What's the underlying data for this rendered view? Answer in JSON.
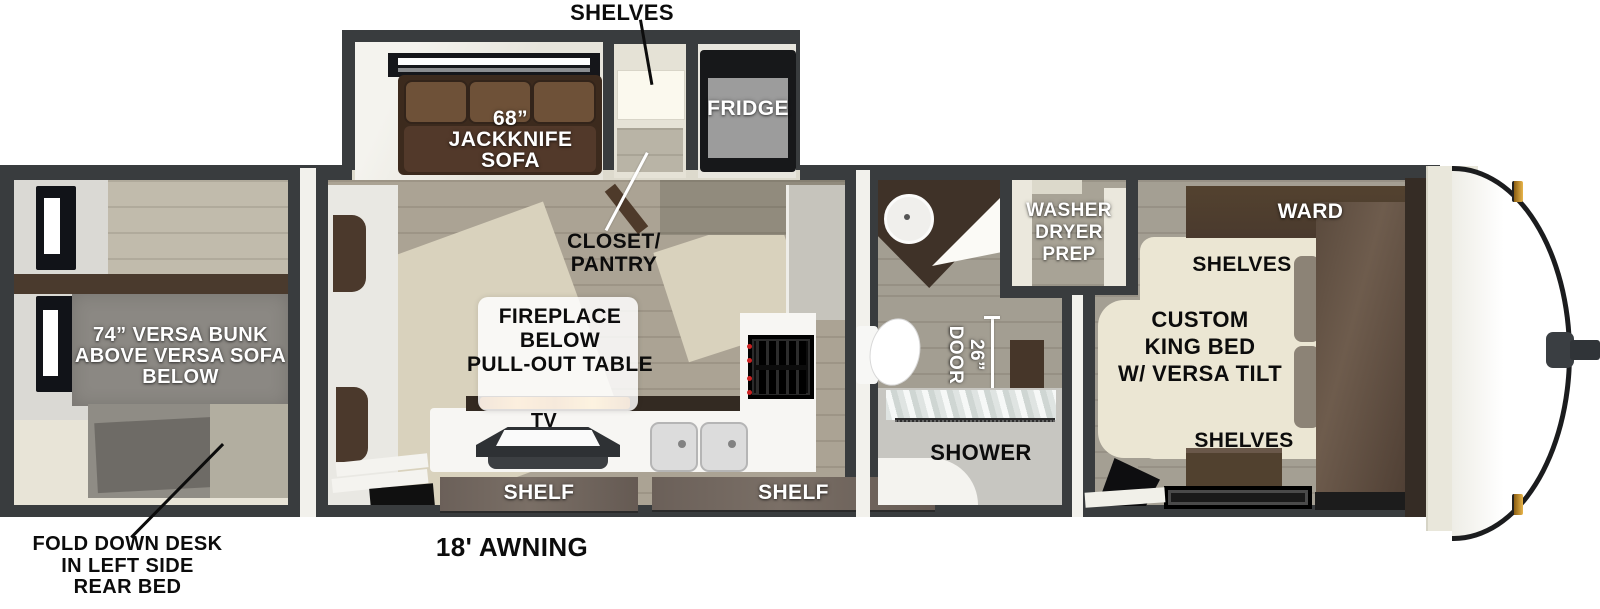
{
  "colors": {
    "wall": "#393c3e",
    "floor_wood": "#aba495",
    "floor_cream": "#d9d2bd",
    "sofa_brown": "#3c2a1d",
    "cabinet_brown": "#4c3c30",
    "flame_accent": "#e89c33",
    "amber_light": "#d9a335"
  },
  "exterior": {
    "awning": "18' AWNING",
    "desk_note": [
      "FOLD DOWN DESK",
      "IN LEFT SIDE",
      "REAR BED"
    ],
    "shelves_callout": "SHELVES",
    "closet_callout": [
      "CLOSET/",
      "PANTRY"
    ]
  },
  "slideout": {
    "sofa": [
      "68”",
      "JACKKNIFE",
      "SOFA"
    ],
    "fridge": "FRIDGE"
  },
  "rear_room": {
    "bunk": [
      "74” VERSA BUNK",
      "ABOVE VERSA SOFA",
      "BELOW"
    ]
  },
  "kitchen": {
    "fireplace": [
      "FIREPLACE",
      "BELOW",
      "PULL-OUT TABLE"
    ],
    "tv": "TV",
    "shelf_left": "SHELF",
    "shelf_right": "SHELF"
  },
  "bathroom": {
    "door": [
      "26”",
      "DOOR"
    ],
    "shower": "SHOWER",
    "washer": [
      "WASHER",
      "DRYER",
      "PREP"
    ]
  },
  "bedroom": {
    "ward": "WARD",
    "shelves_top": "SHELVES",
    "bed": [
      "CUSTOM",
      "KING BED",
      "W/ VERSA TILT"
    ],
    "shelves_bottom": "SHELVES"
  }
}
